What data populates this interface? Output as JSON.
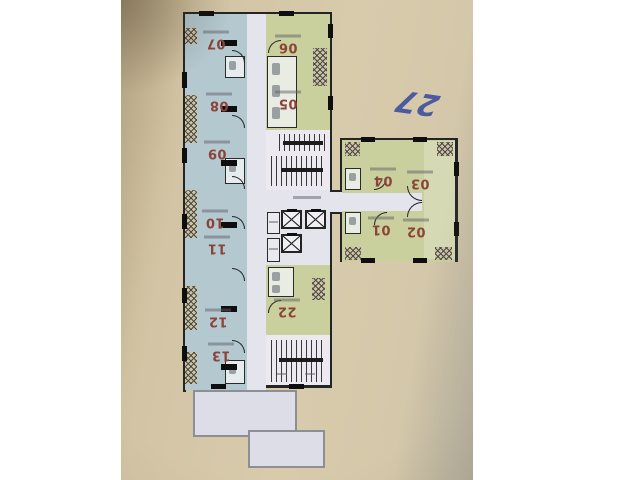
{
  "scene": {
    "description": "photo of an upside-down apartment floor plan",
    "handwritten_note": "27"
  },
  "floor_plan": {
    "units": [
      {
        "label": "07",
        "color_group": "blue"
      },
      {
        "label": "06",
        "color_group": "green"
      },
      {
        "label": "08",
        "color_group": "blue"
      },
      {
        "label": "05",
        "color_group": "green"
      },
      {
        "label": "09",
        "color_group": "blue"
      },
      {
        "label": "10",
        "color_group": "blue"
      },
      {
        "label": "11",
        "color_group": "blue"
      },
      {
        "label": "12",
        "color_group": "blue"
      },
      {
        "label": "13",
        "color_group": "blue"
      },
      {
        "label": "22",
        "color_group": "green"
      },
      {
        "label": "04",
        "color_group": "green"
      },
      {
        "label": "03",
        "color_group": "green"
      },
      {
        "label": "01",
        "color_group": "green"
      },
      {
        "label": "02",
        "color_group": "green"
      }
    ],
    "colors": {
      "blue_unit": "#b3c8cf",
      "green_unit": "#c9cf9d",
      "corridor": "#e4e4ec",
      "wall": "#242424",
      "unit_label": "#8a4438",
      "terrace": "#dcdde6",
      "note_ink": "#35479d",
      "paper": "#d4c6a7"
    }
  }
}
